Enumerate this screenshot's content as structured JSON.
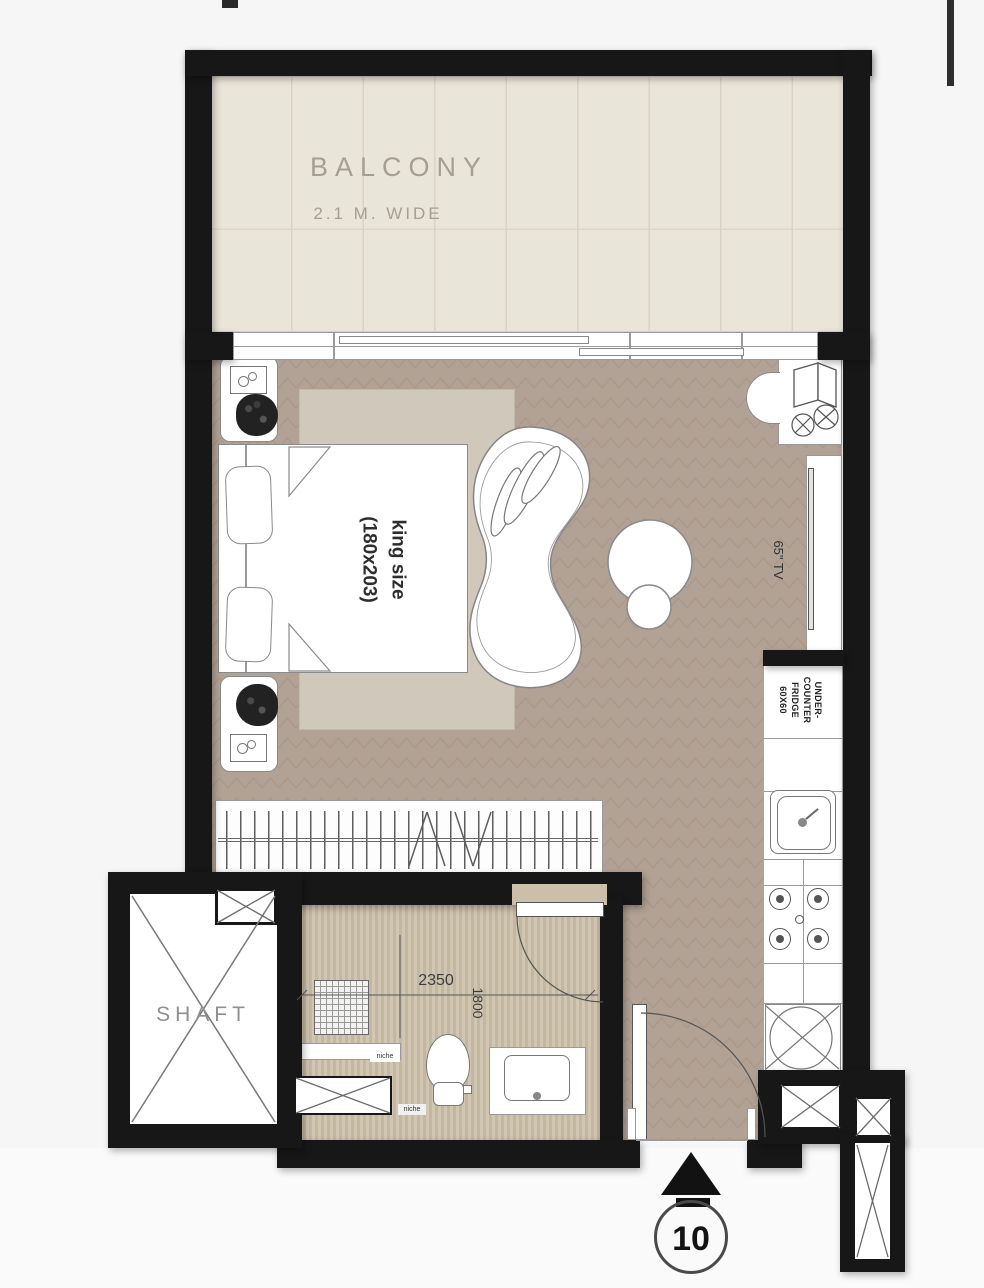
{
  "plan": {
    "balcony": {
      "label": "BALCONY",
      "width_label": "2.1 M. WIDE"
    },
    "bedroom": {
      "bed_label_line1": "king size",
      "bed_label_line2": "(180x203)"
    },
    "living": {
      "tv_label": "65\" TV"
    },
    "kitchen": {
      "fridge_line1": "UNDER-",
      "fridge_line2": "COUNTER",
      "fridge_line3": "FRIDGE",
      "fridge_line4": "60X60"
    },
    "bathroom": {
      "dim_width": "2350",
      "dim_height": "1800",
      "niche_label_1": "niche",
      "niche_label_2": "niche"
    },
    "shaft": {
      "label": "SHAFT"
    },
    "entrance": {
      "unit_number": "10"
    },
    "colors": {
      "wall": "#171717",
      "wood_floor": "#b2a295",
      "wood_line": "#a3927f",
      "balcony_floor": "#eae5d9",
      "bathroom_floor": "#cbbfa9",
      "rug": "#d0c8bb",
      "fixture_stroke": "#8a8a8a",
      "background": "#f6f6f6"
    }
  }
}
